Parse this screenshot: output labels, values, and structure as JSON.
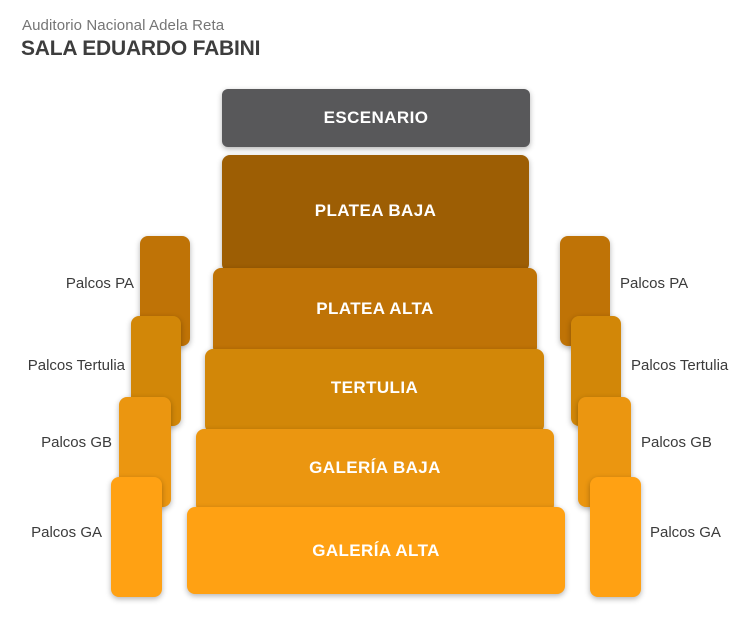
{
  "header": {
    "venue": "Auditorio Nacional Adela Reta",
    "hall": "SALA EDUARDO FABINI"
  },
  "stage": {
    "label": "ESCENARIO",
    "color": "#58585a"
  },
  "sections": [
    {
      "id": "platea-baja",
      "label": "PLATEA BAJA",
      "color": "#9d5e04"
    },
    {
      "id": "platea-alta",
      "label": "PLATEA ALTA",
      "color": "#bf7306"
    },
    {
      "id": "tertulia",
      "label": "TERTULIA",
      "color": "#d28708"
    },
    {
      "id": "galeria-baja",
      "label": "GALERÍA BAJA",
      "color": "#eb9610"
    },
    {
      "id": "galeria-alta",
      "label": "GALERÍA ALTA",
      "color": "#ffa113"
    }
  ],
  "palcos": {
    "left": [
      {
        "label": "Palcos PA",
        "color": "#bf7306"
      },
      {
        "label": "Palcos Tertulia",
        "color": "#d28708"
      },
      {
        "label": "Palcos GB",
        "color": "#eb9610"
      },
      {
        "label": "Palcos GA",
        "color": "#ffa113"
      }
    ],
    "right": [
      {
        "label": "Palcos PA",
        "color": "#bf7306"
      },
      {
        "label": "Palcos Tertulia",
        "color": "#d28708"
      },
      {
        "label": "Palcos GB",
        "color": "#eb9610"
      },
      {
        "label": "Palcos GA",
        "color": "#ffa113"
      }
    ]
  }
}
